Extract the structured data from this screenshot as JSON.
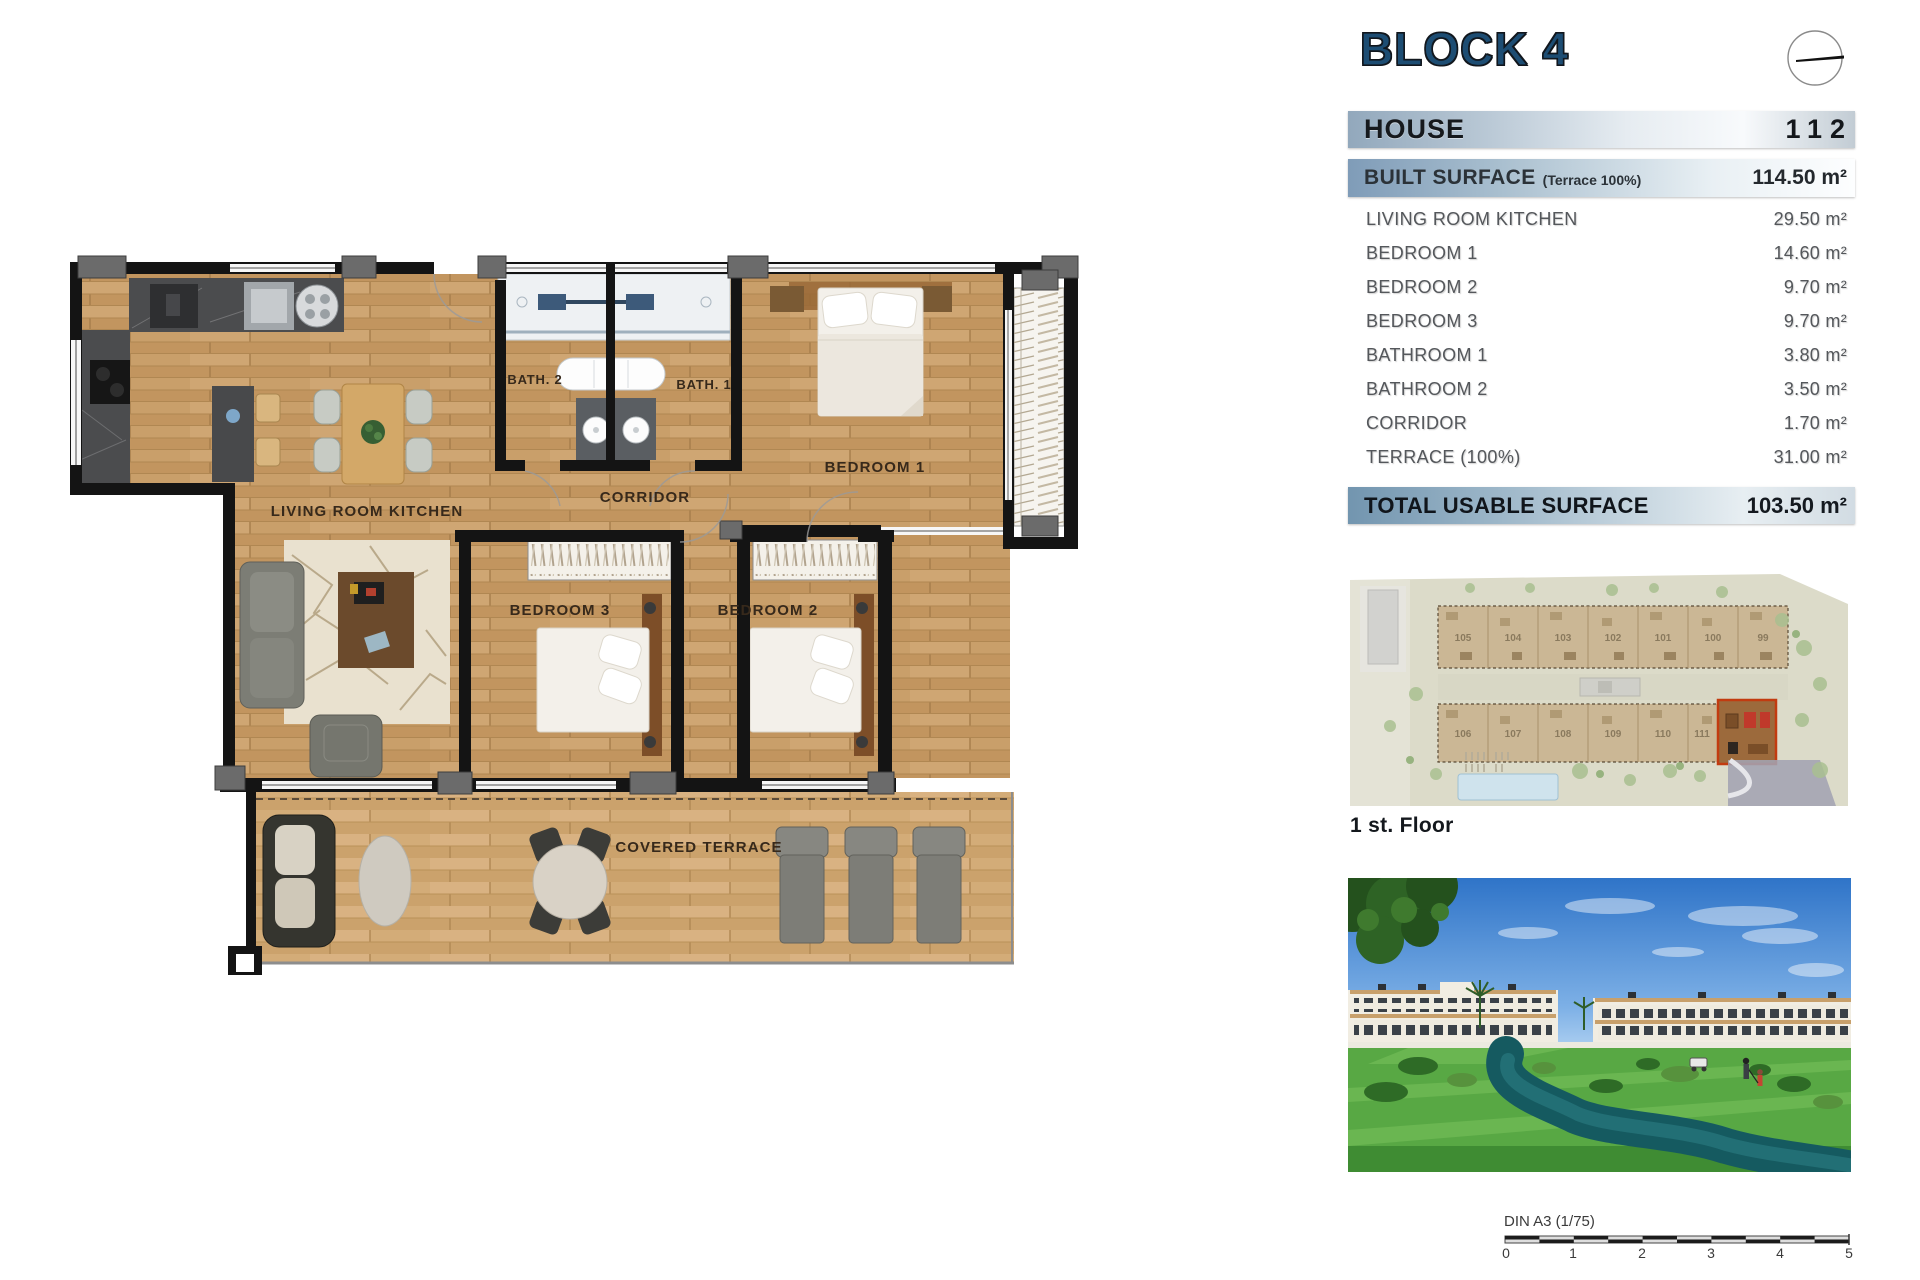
{
  "panel": {
    "block_title": "BLOCK 4",
    "house": {
      "label": "HOUSE",
      "value": "112"
    },
    "built_surface": {
      "label": "BUILT SURFACE",
      "note": "(Terrace 100%)",
      "value": "114.50 m²"
    },
    "rooms": [
      {
        "label": "LIVING ROOM KITCHEN",
        "value": "29.50 m²"
      },
      {
        "label": "BEDROOM 1",
        "value": "14.60 m²"
      },
      {
        "label": "BEDROOM 2",
        "value": "9.70 m²"
      },
      {
        "label": "BEDROOM 3",
        "value": "9.70 m²"
      },
      {
        "label": "BATHROOM 1",
        "value": "3.80 m²"
      },
      {
        "label": "BATHROOM 2",
        "value": "3.50 m²"
      },
      {
        "label": "CORRIDOR",
        "value": "1.70 m²"
      },
      {
        "label": "TERRACE (100%)",
        "value": "31.00 m²"
      }
    ],
    "total": {
      "label": "TOTAL USABLE SURFACE",
      "value": "103.50 m²"
    }
  },
  "floor_plan": {
    "labels": {
      "living_room_kitchen": "LIVING ROOM KITCHEN",
      "bath_2": "BATH. 2",
      "bath_1": "BATH. 1",
      "corridor": "CORRIDOR",
      "bedroom_1": "BEDROOM 1",
      "bedroom_2": "BEDROOM 2",
      "bedroom_3": "BEDROOM 3",
      "covered_terrace": "COVERED TERRACE"
    }
  },
  "site_plan": {
    "caption": "1 st. Floor",
    "top_row_units": [
      "105",
      "104",
      "103",
      "102",
      "101",
      "100",
      "99"
    ],
    "bottom_row_units": [
      "106",
      "107",
      "108",
      "109",
      "110",
      "111"
    ],
    "highlighted_unit": "112"
  },
  "scale_bar": {
    "label": "DIN A3 (1/75)",
    "ticks": [
      "0",
      "1",
      "2",
      "3",
      "4",
      "5"
    ]
  },
  "colors": {
    "accent_navy": "#1d4d73",
    "steel_blue": "#7f9cb8",
    "highlight_red": "#c23b10",
    "wood": "#c99f6a"
  }
}
